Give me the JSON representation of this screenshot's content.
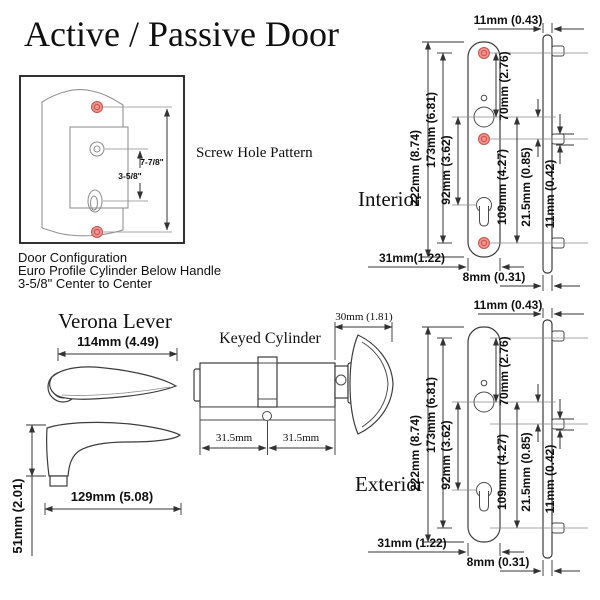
{
  "page": {
    "title": "Active / Passive Door",
    "background": "#ffffff"
  },
  "screw_hole_pattern": {
    "label": "Screw Hole Pattern",
    "total_spacing": "7-7/8\"",
    "center_spacing": "3-5/8\"",
    "caption": [
      "Door Configuration",
      "Euro Profile Cylinder Below Handle",
      "3-5/8\" Center to Center"
    ]
  },
  "interior": {
    "label": "Interior",
    "dims": {
      "top_offset": "11mm (0.43)",
      "total_height": "222mm (8.74)",
      "screw_span": "173mm (6.81)",
      "handle_to_cylinder": "92mm (3.62)",
      "screw_to_handle": "70mm (2.76)",
      "handle_to_screw_bottom": "109mm (4.27)",
      "mid_offset": "21.5mm (0.85)",
      "peg_offset": "11mm (0.42)",
      "plate_width": "31mm(1.22)",
      "side_width": "8mm (0.31)"
    }
  },
  "exterior": {
    "label": "Exterior",
    "dims": {
      "top_offset": "11mm (0.43)",
      "total_height": "222mm (8.74)",
      "screw_span": "173mm (6.81)",
      "handle_to_cylinder": "92mm (3.62)",
      "screw_to_handle": "70mm (2.76)",
      "handle_to_screw_bottom": "109mm (4.27)",
      "mid_offset": "21.5mm (0.85)",
      "peg_offset": "11mm (0.42)",
      "plate_width": "31mm (1.22)",
      "side_width": "8mm (0.31)"
    }
  },
  "verona_lever": {
    "label": "Verona Lever",
    "top_view_length": "114mm (4.49)",
    "side_view_length": "129mm (5.08)",
    "side_view_height": "51mm (2.01)"
  },
  "keyed_cylinder": {
    "label": "Keyed Cylinder",
    "thumbturn_width": "30mm (1.81)",
    "left_half": "31.5mm",
    "right_half": "31.5mm"
  },
  "colors": {
    "line": "#3c3c3c",
    "dimension": "#333333",
    "door_sketch": "#939393",
    "screw_hole_fill": "#f09290",
    "screw_hole_ring": "#c4524d",
    "text": "#101010"
  }
}
